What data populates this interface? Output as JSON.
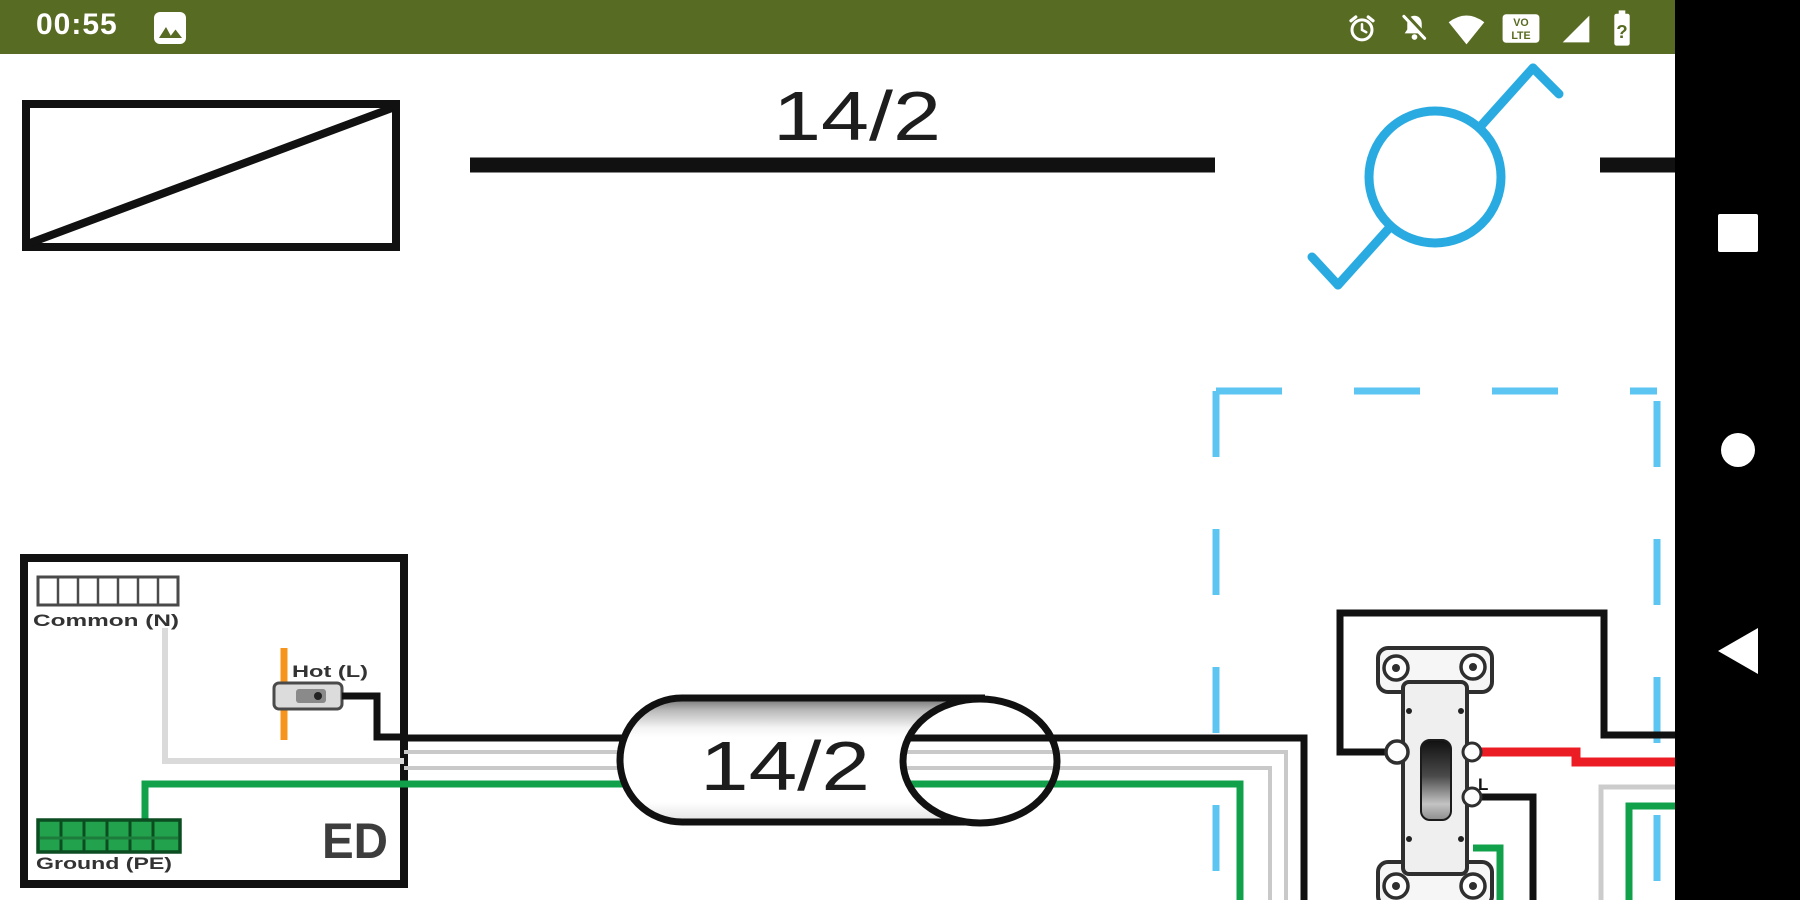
{
  "status_bar": {
    "time": "00:55",
    "icons": [
      "screenshot",
      "alarm",
      "notifications-off",
      "wifi",
      "volte",
      "signal",
      "battery"
    ],
    "volte_top": "VO",
    "volte_bottom": "LTE",
    "battery_glyph": "?"
  },
  "nav_bar": {
    "buttons": [
      "recents",
      "home",
      "back"
    ]
  },
  "diagram": {
    "top_cable_label": "14/2",
    "bundle_label": "14/2",
    "panel": {
      "common_label": "Common (N)",
      "hot_label": "Hot (L)",
      "ground_label": "Ground (PE)",
      "code_label": "ED"
    },
    "switch": {
      "terminal_label": "L"
    },
    "colors": {
      "status_bar_bg": "#586b22",
      "light_symbol_blue": "#29abe2",
      "selection_dash_blue": "#5cc5f1",
      "wire_green": "#12a14b",
      "wire_red": "#ec1c24",
      "hot_orange": "#f7941e",
      "wire_black": "#111111",
      "neutral_gray": "#c9c9c9"
    }
  }
}
